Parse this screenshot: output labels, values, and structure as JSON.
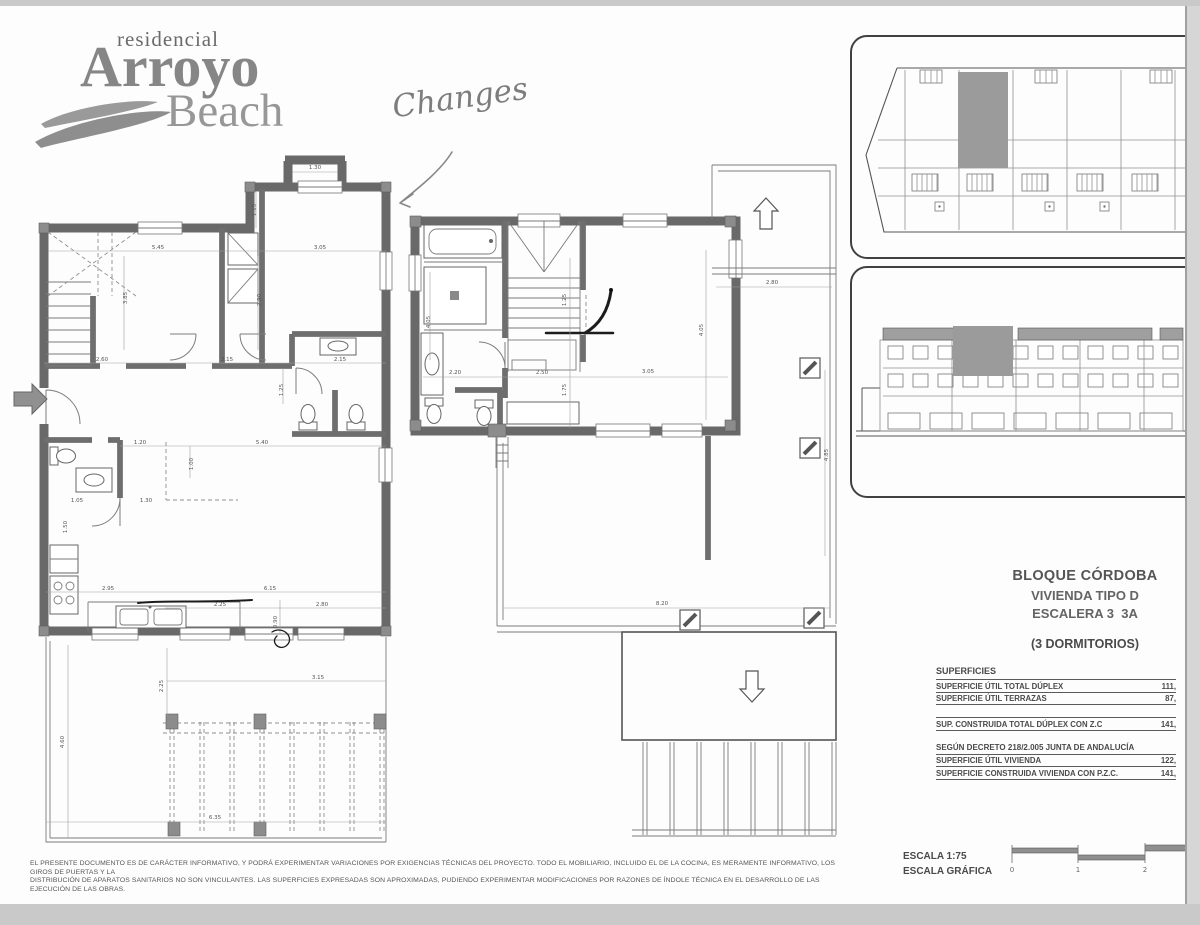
{
  "logo": {
    "small": "residencial",
    "line1": "Arroyo",
    "line2": "Beach"
  },
  "annotation": {
    "text": "Changes"
  },
  "title_block": {
    "line1": "BLOQUE CÓRDOBA",
    "line2": "VIVIENDA TIPO D",
    "line3": "ESCALERA 3  3A",
    "bedrooms": "(3 DORMITORIOS)"
  },
  "superficies": {
    "header": "SUPERFICIES",
    "rows": [
      {
        "label": "SUPERFICIE ÚTIL TOTAL DÚPLEX",
        "value": "111,"
      },
      {
        "label": "SUPERFICIE ÚTIL TERRAZAS",
        "value": "87,"
      }
    ],
    "total_row": {
      "label": "SUP. CONSTRUIDA TOTAL DÚPLEX CON Z.C",
      "value": "141,"
    },
    "decree_header": "SEGÚN DECRETO 218/2.005 JUNTA DE ANDALUCÍA",
    "decree_rows": [
      {
        "label": "SUPERFICIE ÚTIL VIVIENDA",
        "value": "122,"
      },
      {
        "label": "SUPERFICIE CONSTRUIDA VIVIENDA CON P.Z.C.",
        "value": "141,"
      }
    ]
  },
  "disclaimer": {
    "line1": "EL PRESENTE DOCUMENTO ES DE CARÁCTER INFORMATIVO, Y PODRÁ EXPERIMENTAR VARIACIONES POR EXIGENCIAS TÉCNICAS DEL PROYECTO. TODO EL MOBILIARIO, INCLUIDO EL DE LA COCINA, ES MERAMENTE INFORMATIVO, LOS GIROS DE PUERTAS Y LA",
    "line2": "DISTRIBUCIÓN DE APARATOS SANITARIOS NO SON VINCULANTES. LAS SUPERFICIES EXPRESADAS SON APROXIMADAS, PUDIENDO EXPERIMENTAR MODIFICACIONES POR RAZONES DE ÍNDOLE TÉCNICA EN EL DESARROLLO DE LAS EJECUCIÓN DE LAS OBRAS."
  },
  "scale": {
    "label": "ESCALA 1:75",
    "graphic_label": "ESCALA GRÁFICA",
    "ticks": [
      "0",
      "1",
      "2"
    ]
  },
  "plans": {
    "lower": {
      "dims": [
        "1.30",
        "1.15",
        "5.45",
        "3.05",
        "3.85",
        "2.90",
        "2.60",
        "3.15",
        "2.15",
        "1.25",
        "1.20",
        "5.40",
        "1.00",
        "1.05",
        "1.30",
        "1.50",
        "2.95",
        "6.15",
        "2.25",
        "2.80",
        "0.90",
        "4.60",
        "2.25",
        "3.15",
        "6.35"
      ]
    },
    "upper": {
      "dims": [
        "4.05",
        "2.20",
        "2.50",
        "3.05",
        "1.25",
        "1.75",
        "4.05",
        "2.80",
        "4.85",
        "8.20"
      ]
    }
  },
  "colors": {
    "wall": "#8f8f8f",
    "wall_dark": "#696969",
    "thin_line": "#7a7a7a",
    "highlight": "#9b9b9b",
    "ink": "#1c1c1c",
    "text": "#4a4a4a",
    "page_edge": "#c9c9c9"
  }
}
